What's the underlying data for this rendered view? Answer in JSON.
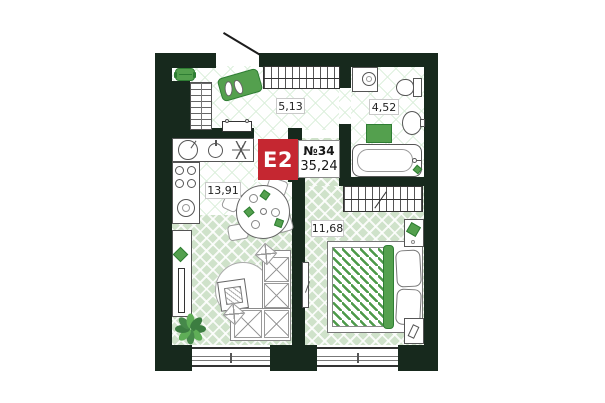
{
  "title": "apartment floor plan",
  "unit": {
    "type_badge": "E2",
    "number": "№34",
    "total_area": "35,24"
  },
  "rooms": [
    {
      "id": "hallway",
      "area": "5,13"
    },
    {
      "id": "bathroom",
      "area": "4,52"
    },
    {
      "id": "kitchen-living",
      "area": "13,91"
    },
    {
      "id": "bedroom",
      "area": "11,68"
    }
  ],
  "colors": {
    "badge": "#c52731",
    "wall": "#17291d",
    "furniture_green": "#54a04e",
    "furniture_green_dark": "#2e7d33",
    "floor_green": "#cfe2ca",
    "tile_line_green": "#def0de"
  }
}
